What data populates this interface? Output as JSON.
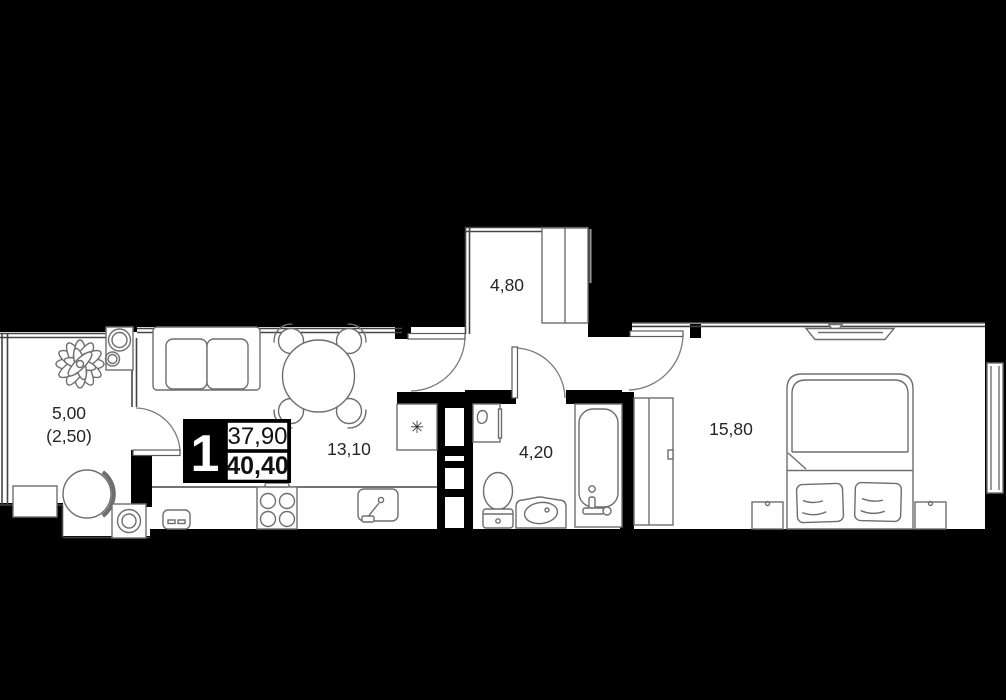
{
  "plan": {
    "badge": {
      "rooms_count": "1",
      "area_upper": "37,90",
      "area_lower": "40,40"
    },
    "rooms": {
      "balcony": {
        "area": "5,00",
        "area_secondary": "(2,50)"
      },
      "hallway": {
        "area": "4,80"
      },
      "living_kitchen": {
        "area": "13,10"
      },
      "bathroom": {
        "area": "4,20"
      },
      "bedroom": {
        "area": "15,80"
      }
    },
    "icons": {
      "fridge_snowflake": "✳"
    },
    "colors": {
      "background": "#000000",
      "floor": "#ffffff",
      "wall": "#000000",
      "thin_wall": "#454545",
      "furniture_stroke": "#6e6e6e",
      "text": "#262626",
      "badge_bg": "#000000",
      "badge_text": "#ffffff"
    }
  }
}
